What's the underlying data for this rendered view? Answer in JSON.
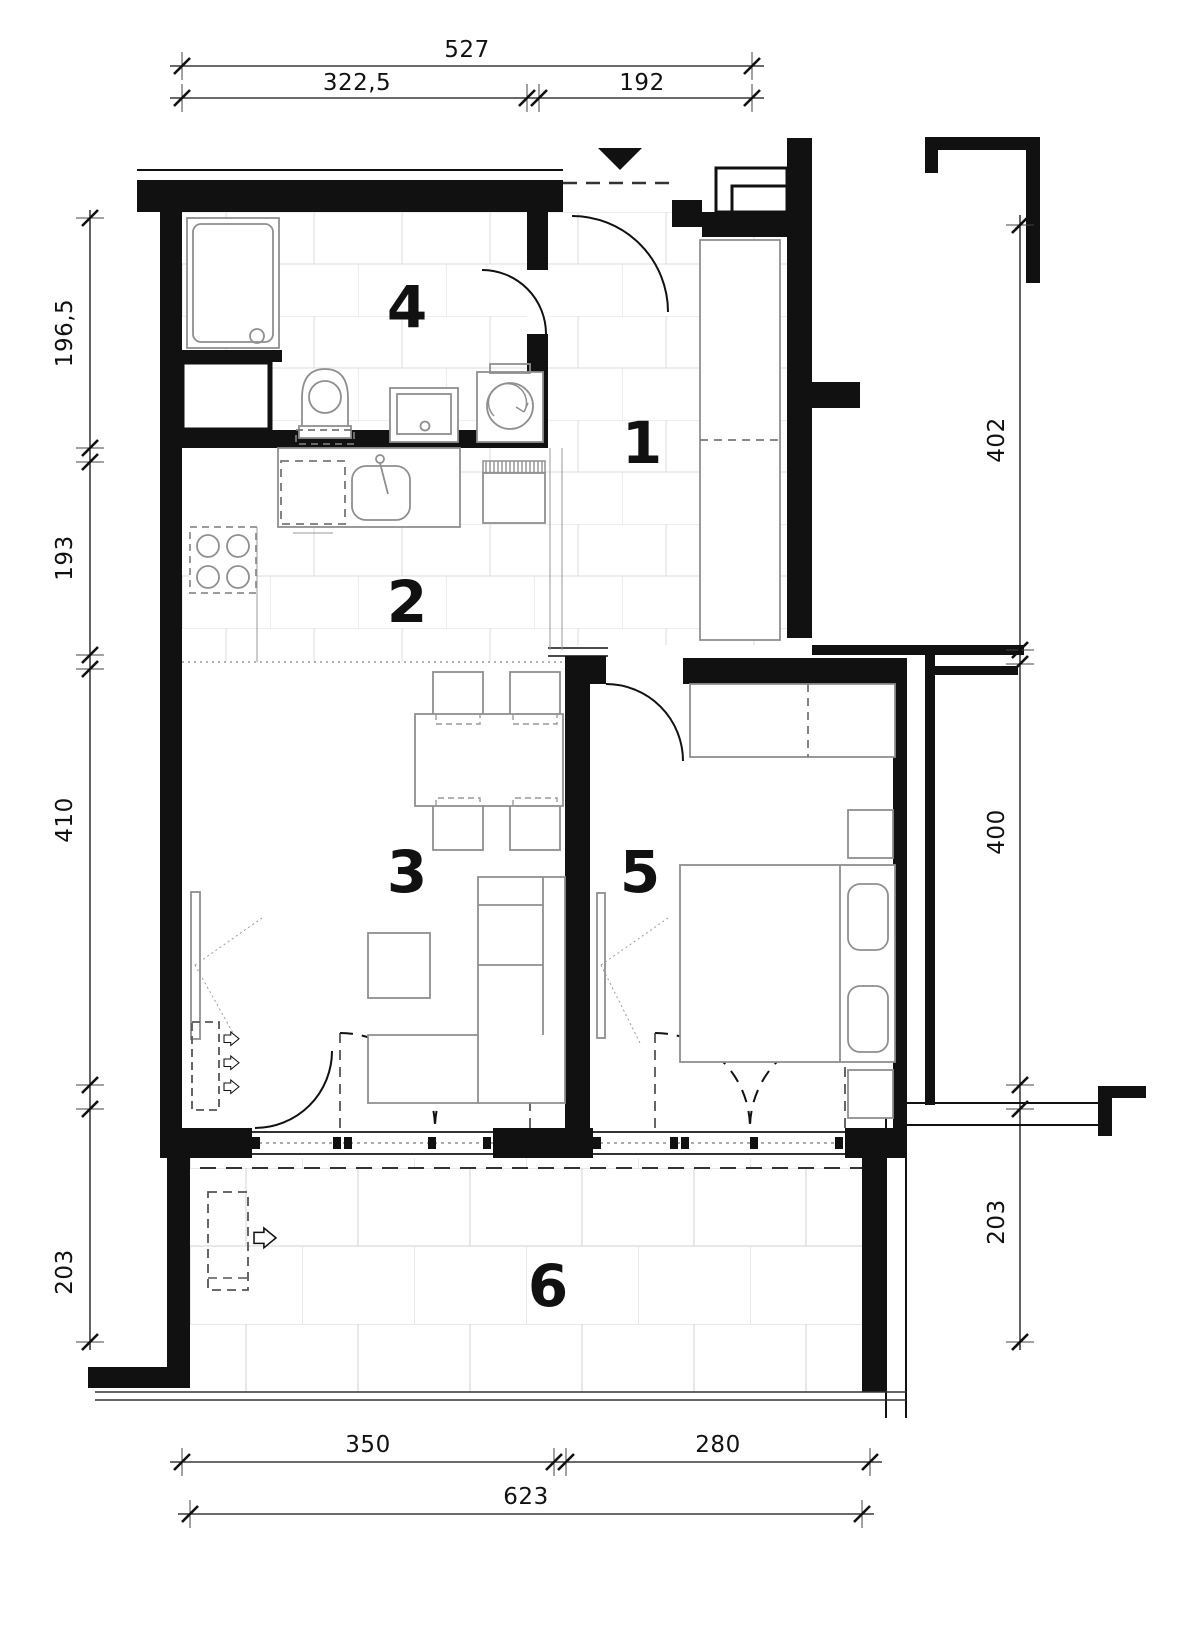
{
  "drawing": {
    "type": "apartment-floor-plan",
    "colors": {
      "wall": "#111111",
      "fixture": "#8f8f8f",
      "tile_line": "#e3e3e3",
      "dimension": "#111111"
    }
  },
  "rooms": [
    {
      "number": "1"
    },
    {
      "number": "2"
    },
    {
      "number": "3"
    },
    {
      "number": "4"
    },
    {
      "number": "5"
    },
    {
      "number": "6"
    }
  ],
  "dimensions": {
    "top": {
      "total": "527",
      "seg1": "322,5",
      "seg2": "192"
    },
    "left": {
      "d1": "196,5",
      "d2": "193",
      "d3": "410",
      "d4": "203"
    },
    "right": {
      "d1": "402",
      "d2": "400",
      "d3": "203"
    },
    "bottom": {
      "seg1": "350",
      "seg2": "280",
      "total": "623"
    }
  }
}
